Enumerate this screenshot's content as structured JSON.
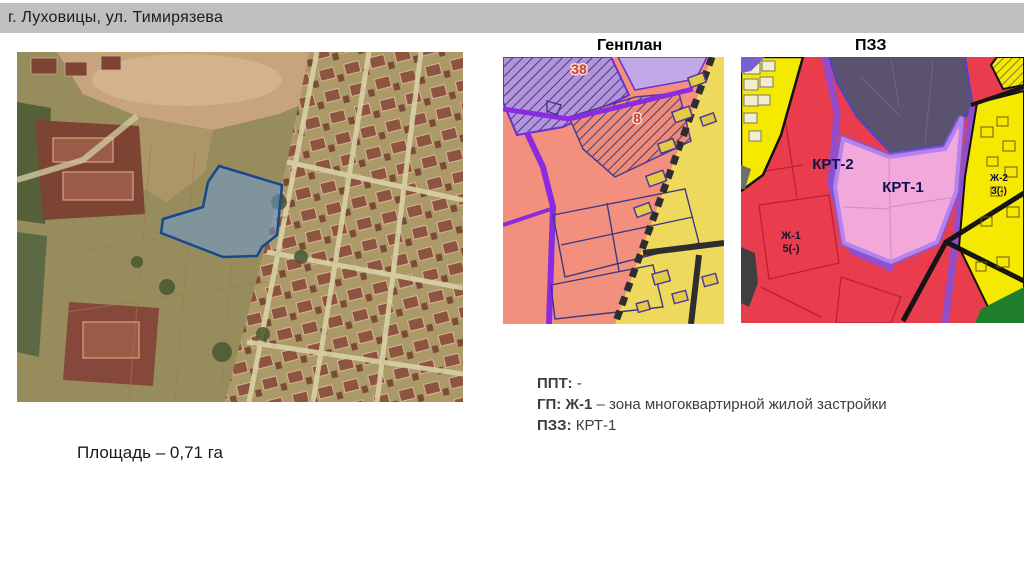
{
  "header": {
    "title": "г. Луховицы, ул. Тимирязева"
  },
  "maps": {
    "genplan": {
      "title": "Генплан",
      "labels": {
        "zone38": "38",
        "zone8": "8"
      }
    },
    "pzz": {
      "title": "ПЗЗ",
      "labels": {
        "krt2": "КРТ-2",
        "krt1": "КРТ-1",
        "zh2_line1": "Ж-2",
        "zh2_line2": "3(-)",
        "zh1_line1": "Ж-1",
        "zh1_line2": "5(-)"
      }
    }
  },
  "info": {
    "line1_label": "ППТ:",
    "line1_value": " -",
    "line2_label": "ГП: Ж-1",
    "line2_value": " – зона многоквартирной жилой застройки",
    "line3_label": "ПЗЗ:",
    "line3_value": " КРТ-1"
  },
  "area_label": "Площадь – 0,71 га",
  "colors": {
    "header_bg": "#bfbfbf",
    "plot_fill": "#6b9bd2",
    "plot_outline": "#17488f",
    "genplan_bg": "#f28f7d",
    "genplan_zone_purple": "#b493dd",
    "genplan_yellow": "#efd95c",
    "genplan_road_purple": "#8a2be2",
    "pzz_red": "#e93d4d",
    "pzz_yellow": "#f6e900",
    "pzz_pink": "#f3a8dc",
    "pzz_slate": "#5b5270",
    "pzz_green": "#1e7e2e"
  }
}
